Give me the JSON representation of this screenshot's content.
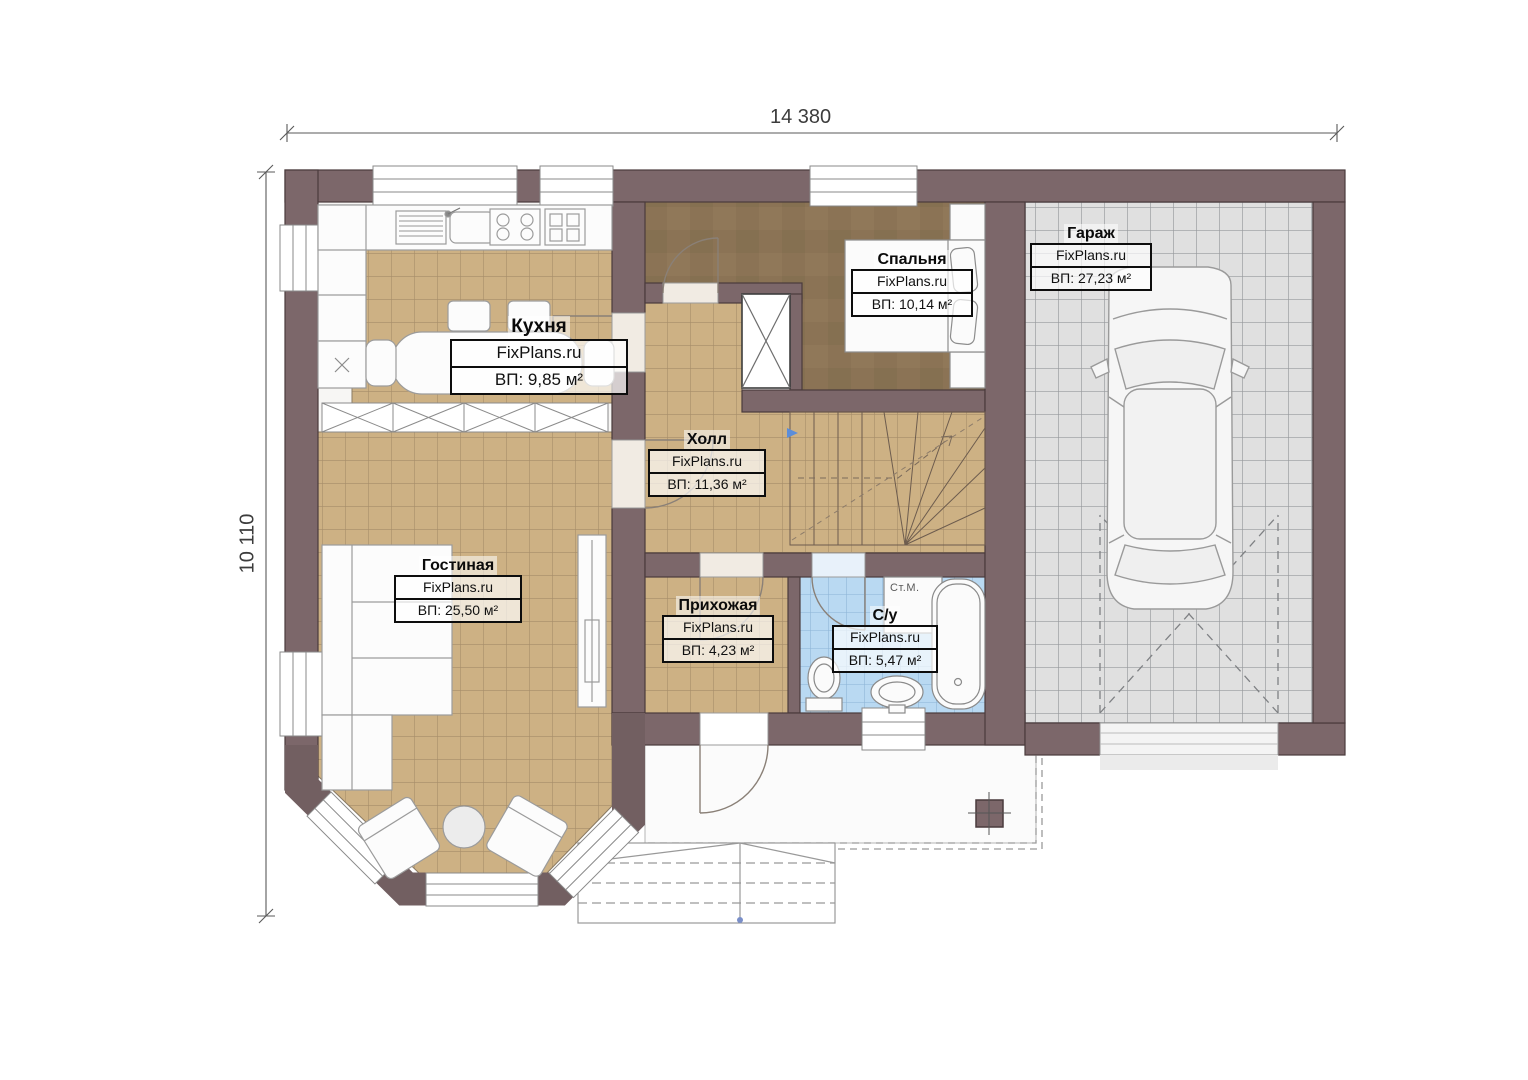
{
  "plan": {
    "dimension_top": "14 380",
    "dimension_left": "10 110",
    "rooms": [
      {
        "name": "Кухня",
        "brand": "FixPlans.ru",
        "area": "ВП: 9,85 м²"
      },
      {
        "name": "Спальня",
        "brand": "FixPlans.ru",
        "area": "ВП: 10,14 м²"
      },
      {
        "name": "Гараж",
        "brand": "FixPlans.ru",
        "area": "ВП: 27,23 м²"
      },
      {
        "name": "Холл",
        "brand": "FixPlans.ru",
        "area": "ВП: 11,36 м²"
      },
      {
        "name": "Гостиная",
        "brand": "FixPlans.ru",
        "area": "ВП: 25,50 м²"
      },
      {
        "name": "Прихожая",
        "brand": "FixPlans.ru",
        "area": "ВП: 4,23 м²"
      },
      {
        "name": "С/у",
        "brand": "FixPlans.ru",
        "area": "ВП: 5,47 м²"
      }
    ],
    "labels": {
      "washing_machine": "Ст.М."
    },
    "colors": {
      "wall": "#7c676a",
      "floor_tile": "#cdb184",
      "floor_wood": "#8b7355",
      "floor_garage": "#e0e0e0",
      "floor_bath": "#b9d9f2"
    }
  }
}
